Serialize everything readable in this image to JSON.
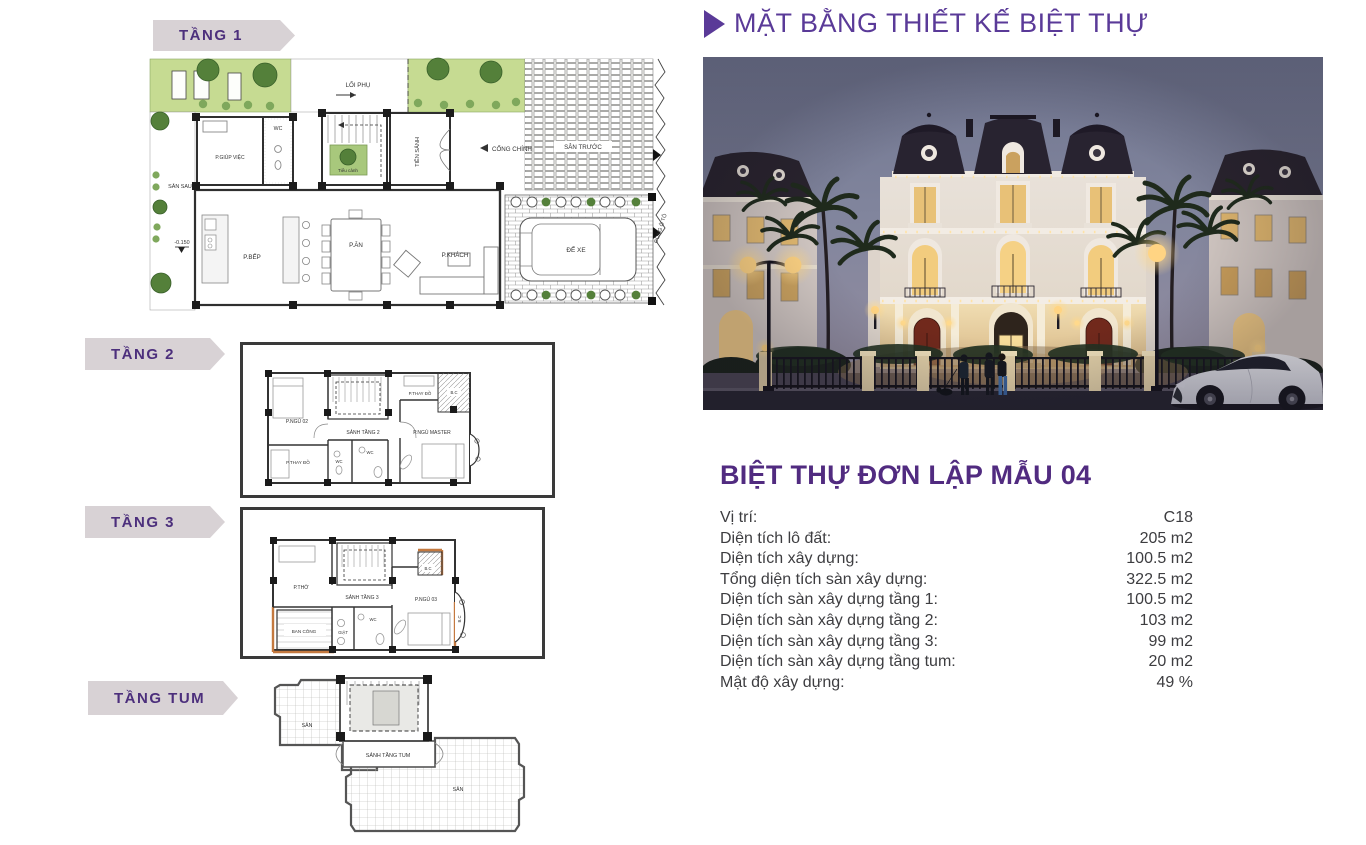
{
  "header": {
    "title": "MẶT BẰNG THIẾT KẾ BIỆT THỰ"
  },
  "plans": {
    "tang1": {
      "banner": "TẦNG 1",
      "labels": {
        "loi_phu": "LỐI PHỤ",
        "san_truoc": "SÂN TRƯỚC",
        "cong_chinh": "CỔNG CHÍNH",
        "tien_sanh": "TIỀN SẢNH",
        "tieu_canh": "Tiểu cảnh",
        "wc": "WC",
        "p_giup_viec": "P.GIÚP VIỆC",
        "san_sau": "SÂN SAU",
        "level_mark": "-0.150",
        "p_bep": "P.BẾP",
        "p_an": "P.ĂN",
        "p_khach": "P.KHÁCH",
        "de_xe": "ĐỂ XE",
        "cong_o_to": "CỔNG Ô TÔ"
      }
    },
    "tang2": {
      "banner": "TẦNG 2",
      "labels": {
        "p_ngu_02": "P.NGỦ 02",
        "p_thay_do_top": "P.THAY ĐỒ",
        "p_thay_do_bottom": "P.THAY ĐỒ",
        "sanh_tang_2": "SẢNH TẦNG 2",
        "p_ngu_master": "P.NGỦ MASTER",
        "wc_left": "WC",
        "wc_right": "WC",
        "bc": "B.C"
      }
    },
    "tang3": {
      "banner": "TẦNG 3",
      "labels": {
        "p_tho": "P.THỜ",
        "sanh_tang_3": "SẢNH TẦNG 3",
        "p_ngu_03": "P.NGỦ 03",
        "ban_cong": "BAN CÔNG",
        "giat": "GIẶT",
        "wc": "WC",
        "bc_top": "B.C",
        "bc_right": "B.C"
      }
    },
    "tangtum": {
      "banner": "TẦNG TUM",
      "labels": {
        "san_left": "SÂN",
        "sanh_tang_tum": "SẢNH TẦNG TUM",
        "san_right": "SÂN"
      }
    }
  },
  "villa": {
    "title": "BIỆT THỰ ĐƠN LẬP MẪU 04",
    "specs": [
      {
        "label": "Vị trí:",
        "value": "C18"
      },
      {
        "label": "Diện tích lô đất:",
        "value": "205 m2"
      },
      {
        "label": "Diện tích xây dựng:",
        "value": "100.5 m2"
      },
      {
        "label": "Tổng diện tích sàn xây dựng:",
        "value": "322.5 m2"
      },
      {
        "label": "Diện tích sàn xây dựng tầng 1:",
        "value": "100.5 m2"
      },
      {
        "label": "Diện tích sàn xây dựng tầng 2:",
        "value": "103 m2"
      },
      {
        "label": "Diện tích sàn xây dựng tầng 3:",
        "value": "99 m2"
      },
      {
        "label": "Diện tích sàn xây dựng tầng tum:",
        "value": "20 m2"
      },
      {
        "label": "Mật độ xây dựng:",
        "value": "49 %"
      }
    ]
  },
  "colors": {
    "accent_purple": "#5a3a98",
    "title_purple": "#512b80",
    "banner_bg": "#d8d2d5",
    "plan_green": "#c6db92",
    "wall": "#2f2f2f",
    "photo_window_glow": "#f2cc7e"
  }
}
